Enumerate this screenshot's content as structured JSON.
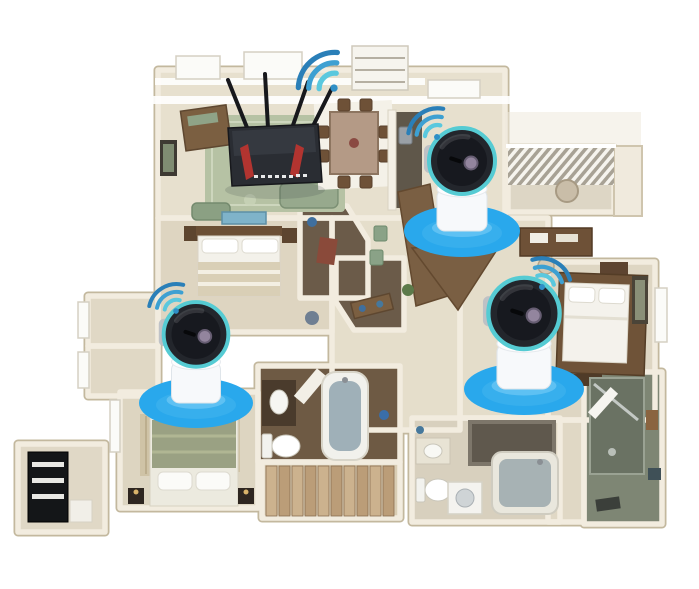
{
  "scene": {
    "description": "3D rendered apartment floor plan showing a WiFi router and three wireless pan-tilt security cameras, each standing on a white base inside a blue WiFi coverage ellipse with signal arcs",
    "style": "isometric dollhouse floor plan illustration",
    "background_color": "#ffffff"
  },
  "colors": {
    "coverage_blue": "#29a8ec",
    "coverage_glow": "#7fd0f7",
    "camera_ring_teal": "#55cbd3",
    "camera_body_dark": "#23262c",
    "camera_base_white": "#f7f9fb",
    "router_body": "#2a2d33",
    "router_accent": "#b23430",
    "wifi_arc_dark": "#2a7fb8",
    "wifi_arc_mid": "#3da0d2",
    "wifi_arc_light": "#5ac8de",
    "wall_cream": "#f2ecdf",
    "wall_edge": "#c3b89e",
    "floor_beige": "#e7e0ce",
    "rug_green": "#b6c2a4",
    "wood_brown": "#7a5f43",
    "bathroom_wood_floor": "#6e5a44",
    "stair_wood": "#ccb28e",
    "tub_water": "#9fb0b8",
    "green_tile": "#7e8674"
  },
  "devices": {
    "router": {
      "name": "wifi-router",
      "antenna_count": 4,
      "location": "living-room",
      "signal_icon": "wifi-signal-icon"
    },
    "cameras": [
      {
        "name": "camera-1",
        "location": "center-hallway-by-kitchen",
        "parts": [
          "camera-head",
          "camera-base",
          "coverage-ellipse",
          "wifi-arcs"
        ]
      },
      {
        "name": "camera-2",
        "location": "hall-outside-master-bedroom",
        "parts": [
          "camera-head",
          "camera-base",
          "coverage-ellipse",
          "wifi-arcs"
        ]
      },
      {
        "name": "camera-3",
        "location": "bottom-left-bedroom",
        "parts": [
          "camera-head",
          "camera-base",
          "coverage-ellipse",
          "wifi-arcs"
        ]
      }
    ]
  },
  "rooms_visible": [
    "living-room",
    "dining-area",
    "balcony",
    "kitchen",
    "top-bedroom",
    "master-bedroom",
    "bottom-left-bedroom",
    "center-bathroom",
    "right-bathroom",
    "far-right-shower-room",
    "staircase",
    "entry-closet",
    "hallway"
  ]
}
